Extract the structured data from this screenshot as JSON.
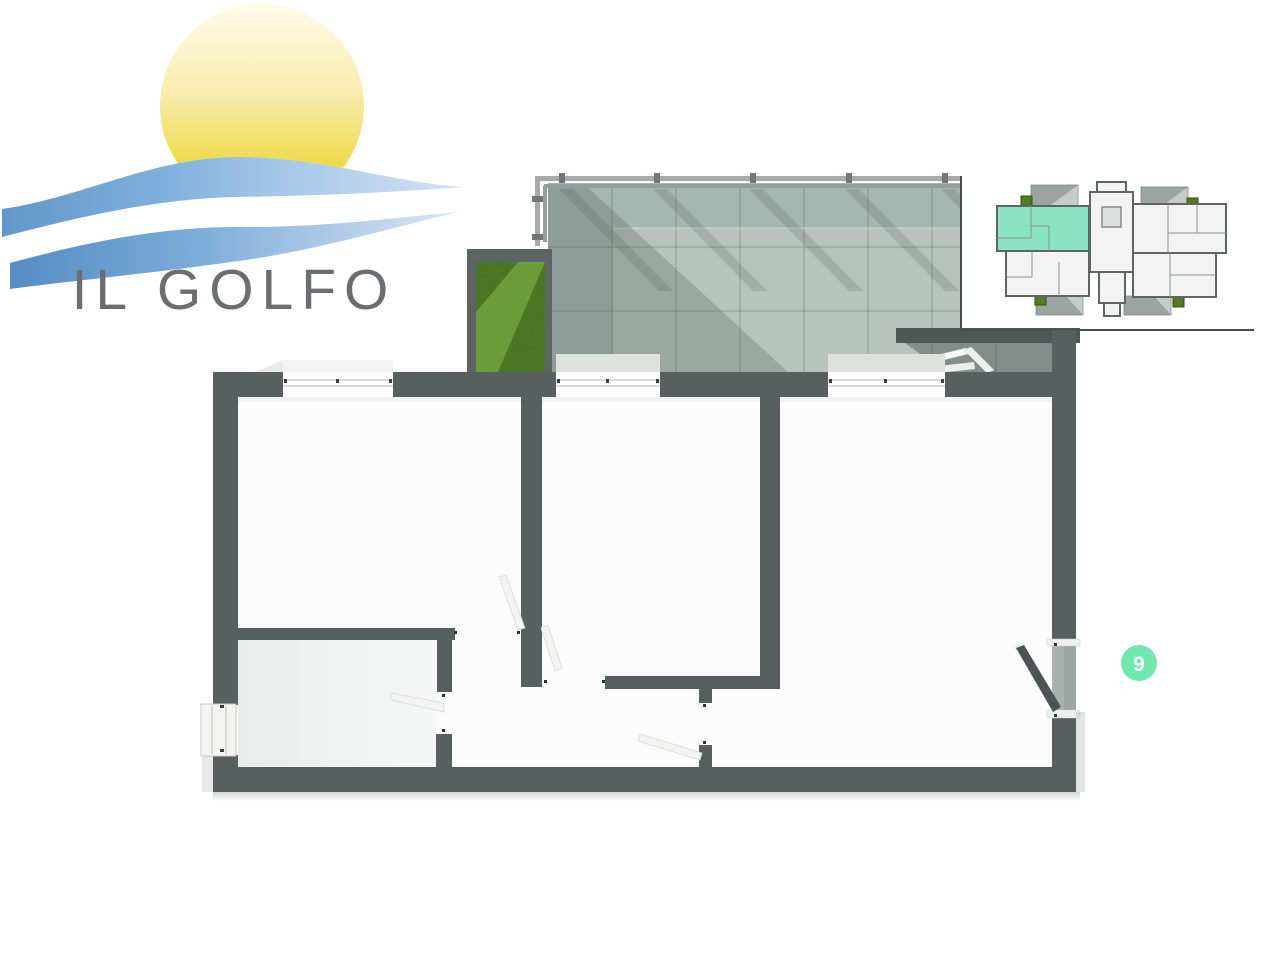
{
  "logo": {
    "title": "IL GOLFO"
  },
  "unit_badge": {
    "number": "9"
  },
  "colors": {
    "wall": "#57605e",
    "floor": "#fbfcfb",
    "terrace_tile": "#b2bdb8",
    "terrace_upper": "#a5b7b1",
    "terrace_lower": "#b9c3be",
    "parapet": "#4e5756",
    "grass": "#47701f",
    "grass_light": "#6f9e38",
    "mint_highlight": "#8ae4c4",
    "badge_green": "#6fe7ad",
    "railing": "#a6abaa",
    "door_dark": "#4b5453",
    "logo_text": "#6a6e71",
    "minimap_line": "#474e4c"
  }
}
